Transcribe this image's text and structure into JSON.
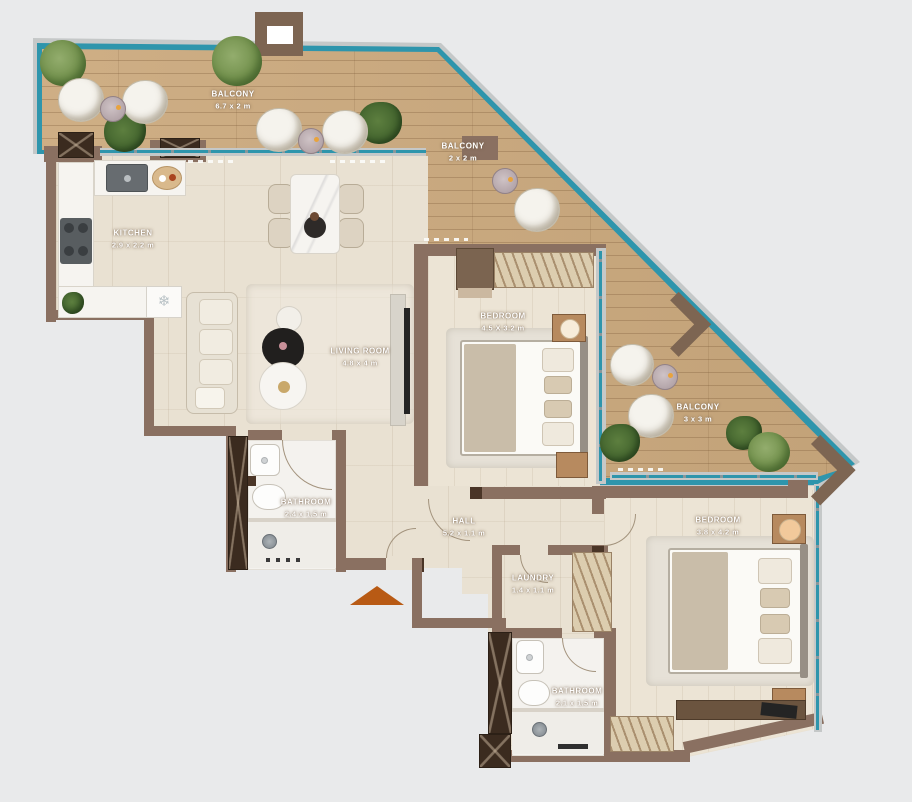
{
  "plan": {
    "type": "apartment-floor-plan",
    "background": "#e9eaeb",
    "colors": {
      "deck_wood": "#ccaa7e",
      "wall": "#8a7061",
      "wall_dark": "#3b2b1f",
      "glass_rail": "#2e95ac",
      "frame": "#c5c8c8",
      "interior_floor": "#e9e1d2",
      "bath_floor": "#f4f2ee",
      "marble": "#f6f4f0",
      "entrance_arrow": "#b85a14",
      "plant_green": "#74924e"
    },
    "icons": {
      "snowflake": "❄"
    },
    "rooms": [
      {
        "id": "balcony-top",
        "name": "BALCONY",
        "dims": "6.7 x 2 m"
      },
      {
        "id": "balcony-middle",
        "name": "BALCONY",
        "dims": "2 x 2 m"
      },
      {
        "id": "kitchen",
        "name": "KITCHEN",
        "dims": "2.9 x 2.2 m"
      },
      {
        "id": "living-room",
        "name": "LIVING ROOM",
        "dims": "4.8 x 4 m"
      },
      {
        "id": "bedroom-1",
        "name": "BEDROOM",
        "dims": "4.5 X 3.2 m"
      },
      {
        "id": "balcony-right",
        "name": "BALCONY",
        "dims": "3 x 3 m"
      },
      {
        "id": "bedroom-2",
        "name": "BEDROOM",
        "dims": "3.8 x 4.2 m"
      },
      {
        "id": "bathroom-1",
        "name": "BATHROOM",
        "dims": "2.4 x 1.5 m"
      },
      {
        "id": "hall",
        "name": "HALL",
        "dims": "5.2 x 1.1 m"
      },
      {
        "id": "laundry",
        "name": "LAUNDRY",
        "dims": "1.4 x 1.1 m"
      },
      {
        "id": "bathroom-2",
        "name": "BATHROOM",
        "dims": "2.1 x 1.5 m"
      }
    ]
  }
}
